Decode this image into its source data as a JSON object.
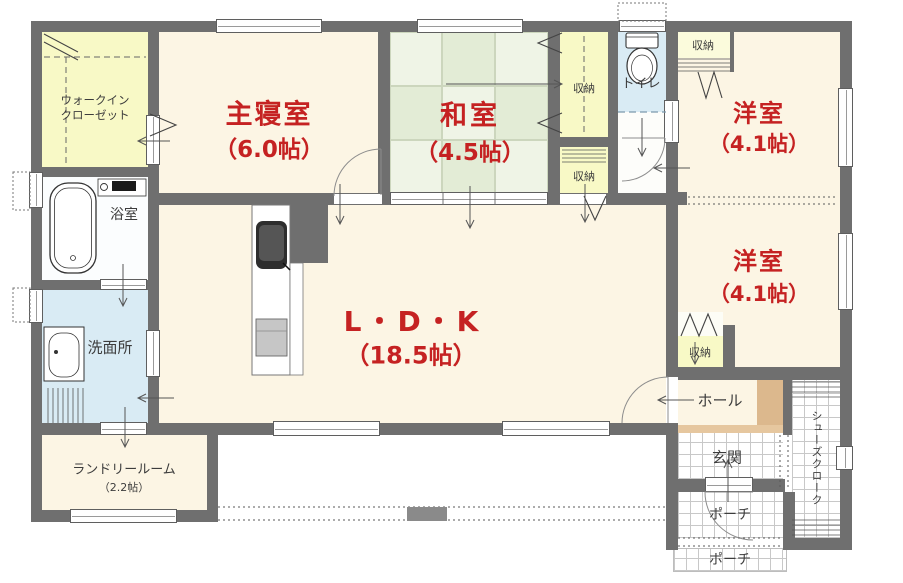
{
  "title": "1-story house floor plan",
  "colors": {
    "wall": "#6f6f6f",
    "accent_red": "#c52222",
    "floor_cream": "#fcf5e4",
    "closet_yellow": "#f8f9c6",
    "water_blue": "#d9ebf4",
    "tatami_light": "#eff4e6",
    "tatami_dark": "#e3ecd6",
    "step_tan": "#dcb88d"
  },
  "rooms": {
    "walk_in_closet": {
      "line1": "ウォークイン",
      "line2": "クローゼット"
    },
    "master_bedroom": {
      "name": "主寝室",
      "size": "（6.0帖）"
    },
    "japanese_room": {
      "name": "和室",
      "size": "（4.5帖）"
    },
    "western_room_1": {
      "name": "洋室",
      "size": "（4.1帖）"
    },
    "western_room_2": {
      "name": "洋室",
      "size": "（4.1帖）"
    },
    "ldk": {
      "name": "L・D・K",
      "size": "（18.5帖）"
    },
    "laundry_room": {
      "name": "ランドリールーム",
      "size": "（2.2帖）"
    },
    "bathroom": {
      "name": "浴室"
    },
    "washroom": {
      "name": "洗面所"
    },
    "toilet": {
      "name": "トイレ"
    },
    "hall": {
      "name": "ホール"
    },
    "entrance": {
      "name": "玄関"
    },
    "porch_upper": {
      "name": "ポーチ"
    },
    "porch_lower": {
      "name": "ポーチ"
    },
    "shoe_closet": {
      "name": "シューズクローク"
    },
    "storage_japanese": {
      "name": "収納"
    },
    "storage_ldk": {
      "name": "収納"
    },
    "storage_west1": {
      "name": "収納"
    },
    "storage_west2": {
      "name": "収納"
    }
  }
}
